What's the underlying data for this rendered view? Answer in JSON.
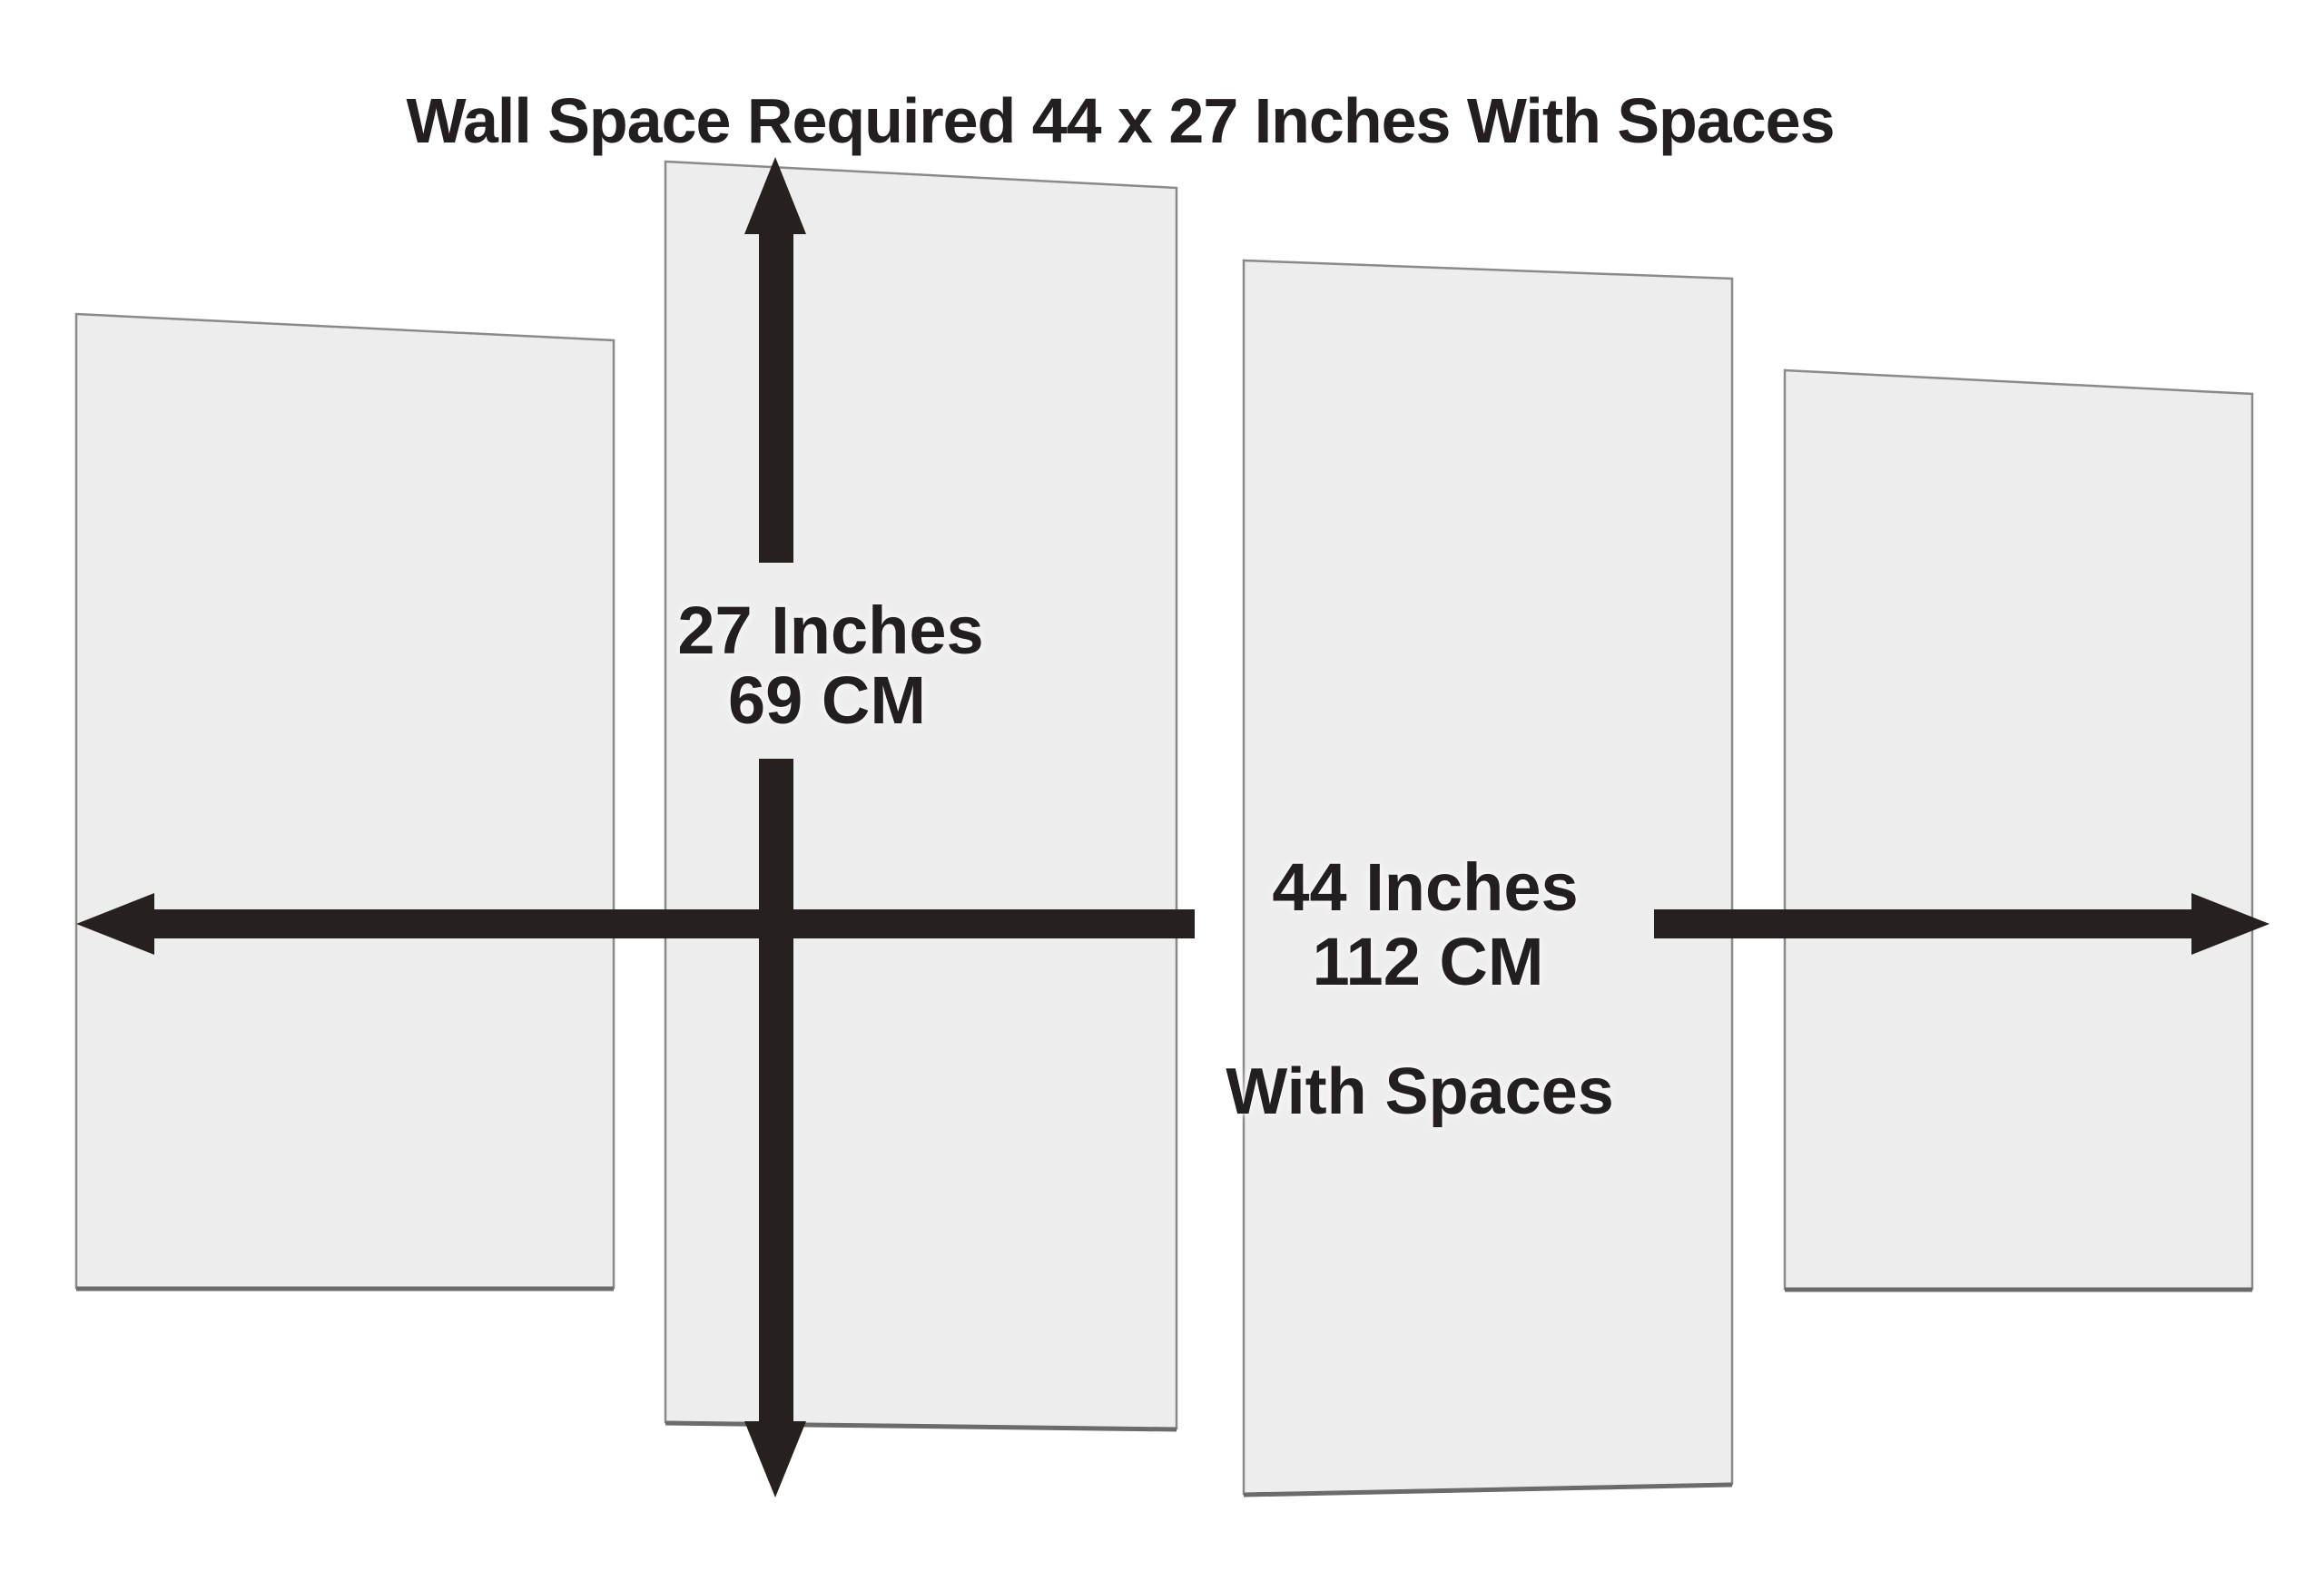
{
  "title": "Wall Space Required 44 x 27 Inches With Spaces",
  "vertical_dimension": {
    "line1": "27 Inches",
    "line2": "69 CM"
  },
  "horizontal_dimension": {
    "line1": "44 Inches",
    "line2": "112 CM",
    "note": "With Spaces"
  },
  "panels": {
    "count": 4
  },
  "icons": {
    "vertical_arrow": "double-headed-vertical-arrow-icon",
    "horizontal_arrow": "double-headed-horizontal-arrow-icon"
  },
  "colors": {
    "background": "#ffffff",
    "panel_fill": "#eeeded",
    "panel_border": "#8a8a8a",
    "panel_bottom_edge": "#6b6b6b",
    "arrow": "#26211f",
    "text": "#231f20"
  }
}
